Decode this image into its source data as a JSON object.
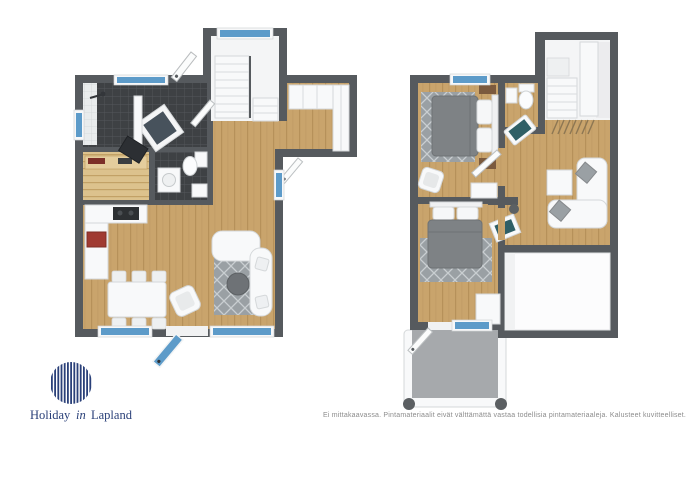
{
  "branding": {
    "logo_holiday": "Holiday",
    "logo_in": "in",
    "logo_lapland": "Lapland"
  },
  "footer": {
    "disclaimer": "Ei mittakaavassa. Pintamateriaalit eivät välttämättä vastaa todellisia pintamateriaaleja. Kalusteet kuvitteelliset."
  },
  "colors": {
    "wall": "#565a5e",
    "wood_floor": "#c9a46c",
    "wood_floor_line": "#b18c55",
    "dark_tile": "#3e4144",
    "tile_grid": "#54575b",
    "window_blue": "#5d9bc9",
    "bed_gray": "#7e8285",
    "rug_gray": "#9aa0a4",
    "rug_pattern": "#c9ced1",
    "sauna_wood": "#dcc28d",
    "sauna_wood_line": "#c2a166",
    "balcony_gray": "#a6a9ac",
    "stove_red": "#a03a32",
    "teal_accent": "#2f5f66",
    "table_gray": "#6e7276",
    "logo_navy": "#2a4079",
    "disclaimer_gray": "#8c8c8c"
  }
}
